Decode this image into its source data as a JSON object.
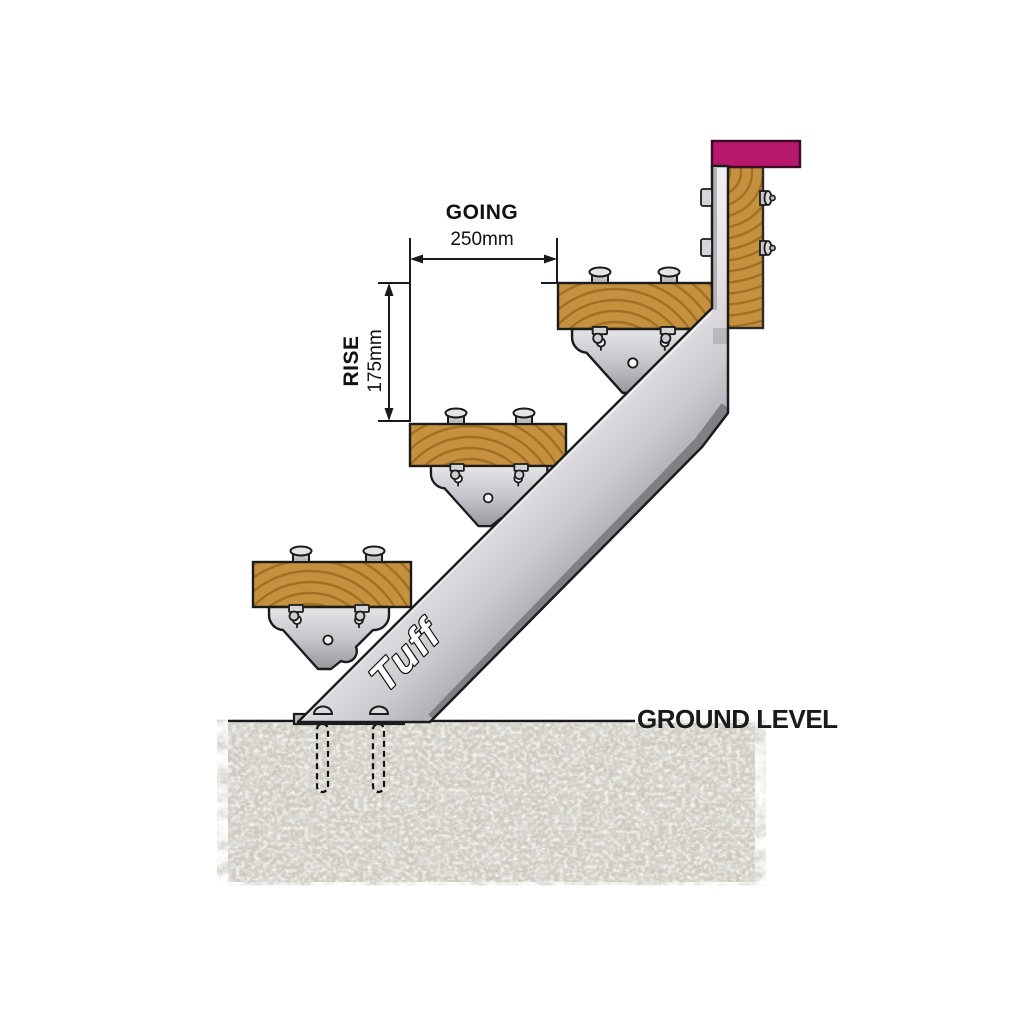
{
  "labels": {
    "going": "GOING",
    "going_value": "250mm",
    "rise": "RISE",
    "rise_value": "175mm",
    "ground": "GROUND LEVEL",
    "brand": "Tuff"
  },
  "structure": {
    "treads": 3,
    "stair_brackets": 3,
    "bolts_per_tread": 2,
    "post_bolts": 2,
    "ground_anchors": 2
  },
  "colors": {
    "wood": "#C6913F",
    "wood_grain": "#96681F",
    "cap": "#B8186C",
    "metal_light": "#E9E9EC",
    "metal_mid": "#C4C4C9",
    "metal_dark": "#7F7F85",
    "outline": "#1C1C1C",
    "concrete": "#CDC9C0",
    "concrete_speckle": "#AFAA9D",
    "dimension": "#1A1A1A"
  }
}
